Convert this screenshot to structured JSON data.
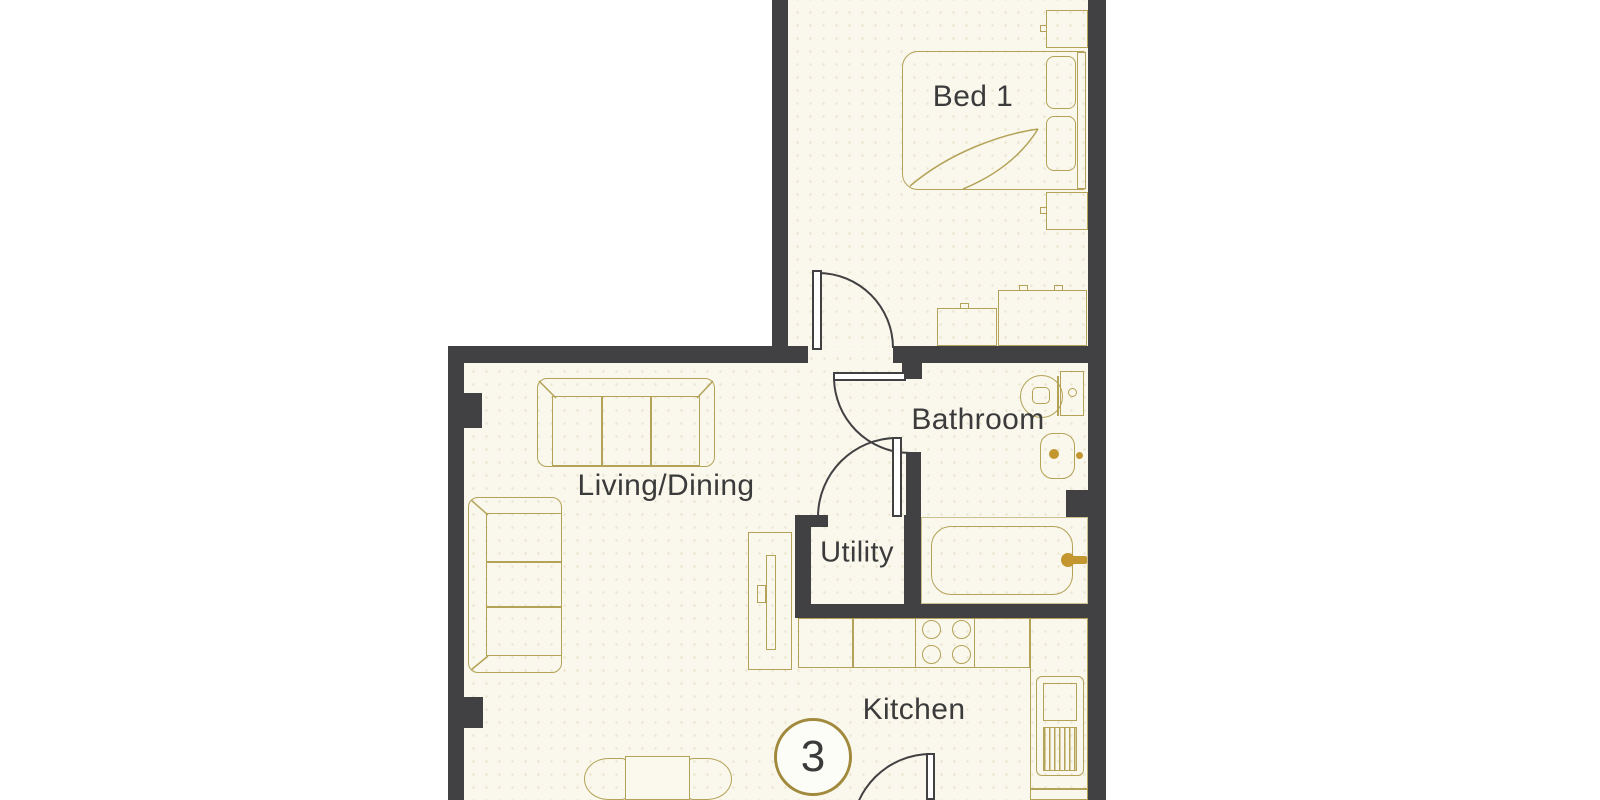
{
  "floorplan": {
    "title": "apartment-floor-plan",
    "rooms": {
      "bed1": {
        "label": "Bed 1"
      },
      "bathroom": {
        "label": "Bathroom"
      },
      "living_dining": {
        "label": "Living/Dining"
      },
      "utility": {
        "label": "Utility"
      },
      "kitchen": {
        "label": "Kitchen"
      }
    },
    "plot_badge": {
      "number": "3"
    },
    "furniture": [
      "double-bed",
      "pillows",
      "headboard",
      "nightstand-top",
      "nightstand-bottom",
      "dresser-small",
      "dresser-large",
      "sofa-three-seat-top",
      "sofa-three-seat-left",
      "tv-unit",
      "dining-table",
      "dining-chair-left",
      "dining-chair-right",
      "kitchen-counter",
      "hob-four-burners",
      "tall-appliance-unit",
      "bathtub",
      "bath-faucet",
      "toilet",
      "wash-basin"
    ],
    "doors": [
      "bedroom-door",
      "bathroom-door",
      "utility-door",
      "kitchen-door"
    ],
    "colors": {
      "wall": "#414042",
      "furniture_line": "#b3a258",
      "accent_gold": "#c3962f",
      "floor": "#faf8ec",
      "floor_dot": "#ece5d1",
      "label_text": "#3b3b3b",
      "badge_ring": "#a18a3d",
      "background": "#ffffff"
    }
  }
}
